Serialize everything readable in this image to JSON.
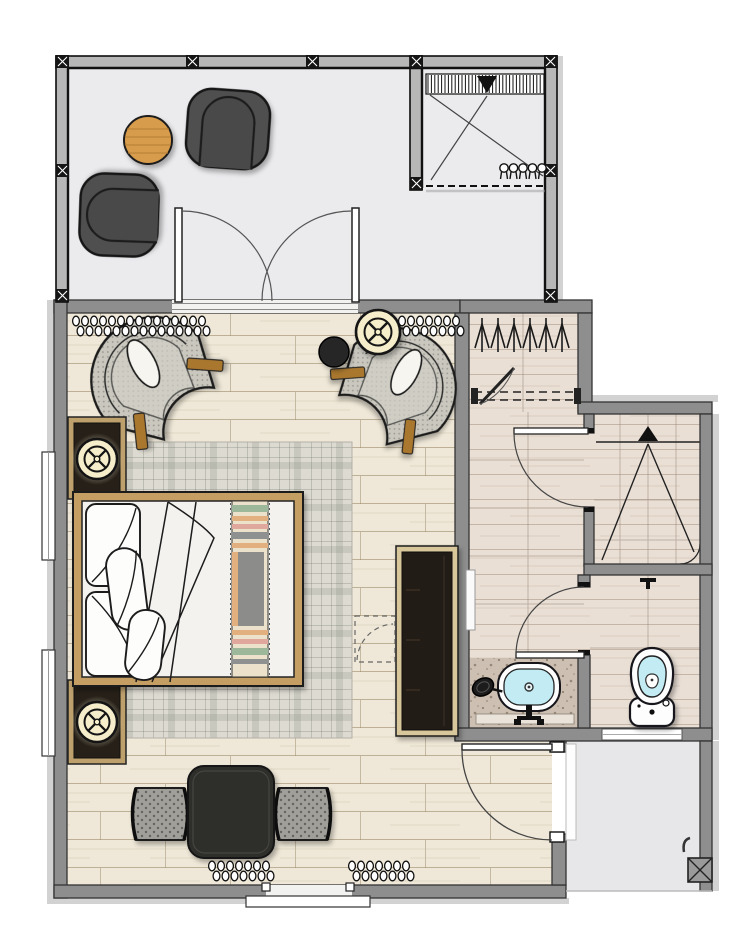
{
  "document": {
    "kind": "architectural floor plan",
    "view": "top-down furnished plan"
  },
  "palette": {
    "background": "#ffffff",
    "wall_gray": "#8e8e8e",
    "wall_edge": "#343434",
    "frame_black": "#141414",
    "frame_infill": "#b7b7b7",
    "terrace_floor": "#ebebee",
    "wood_floor": "#efe8d8",
    "wood_line": "#9b8a6c",
    "bath_floor": "#e9dfd5",
    "rug_base": "#dddbd1",
    "bed_frame_wood": "#c49e62",
    "chair_trim_wood": "#a9772f",
    "terrace_table_wood": "#d89c4d",
    "dark_furniture": "#2f2e2c",
    "lounge_chair": "#4f4f4f",
    "fabric_gray": "#c9c7be",
    "lamp_cream": "#f6eecb",
    "water_blue": "#c2ebf4",
    "terrazzo": "#cdc0b2",
    "throw_green": "#9cb79a",
    "throw_orange": "#e2b07e",
    "throw_pink": "#e0a79c",
    "throw_gray": "#8c8c8a"
  },
  "rooms": {
    "terrace": {
      "name": "Terrace with lounge chairs and side table"
    },
    "court": {
      "name": "Open-air louvered court with planting"
    },
    "bedroom": {
      "name": "Bedroom"
    },
    "closet": {
      "name": "Wardrobe closet with hangers and shelf"
    },
    "vestibule": {
      "name": "Bathroom vestibule"
    },
    "shower": {
      "name": "Shower room with sloped floor to drain"
    },
    "wc": {
      "name": "Toilet room"
    },
    "vanity": {
      "name": "Vanity counter with sink and mirror"
    },
    "entry": {
      "name": "Entry walkway with column"
    }
  },
  "furniture": {
    "terrace_lounge_chairs": 2,
    "terrace_round_table": "round wood side table",
    "bedroom_fan_chairs": 2,
    "bedroom_side_table": "dark round side table",
    "bedroom_tray_table": "cream tray-top round table",
    "nightstands": 2,
    "lamps": "round cream lamps with cross spokes",
    "bed": "double bed with bolster pillows, folded duvet and striped throw",
    "rug": "plaid area rug",
    "tv_console": "dark media console with wood frame",
    "bench_set": "square dark table with two upholstered benches",
    "curtain_symbols": 4,
    "fixtures": [
      "oval basin with faucet",
      "cosmetic mirror",
      "toilet",
      "floor drain"
    ]
  }
}
